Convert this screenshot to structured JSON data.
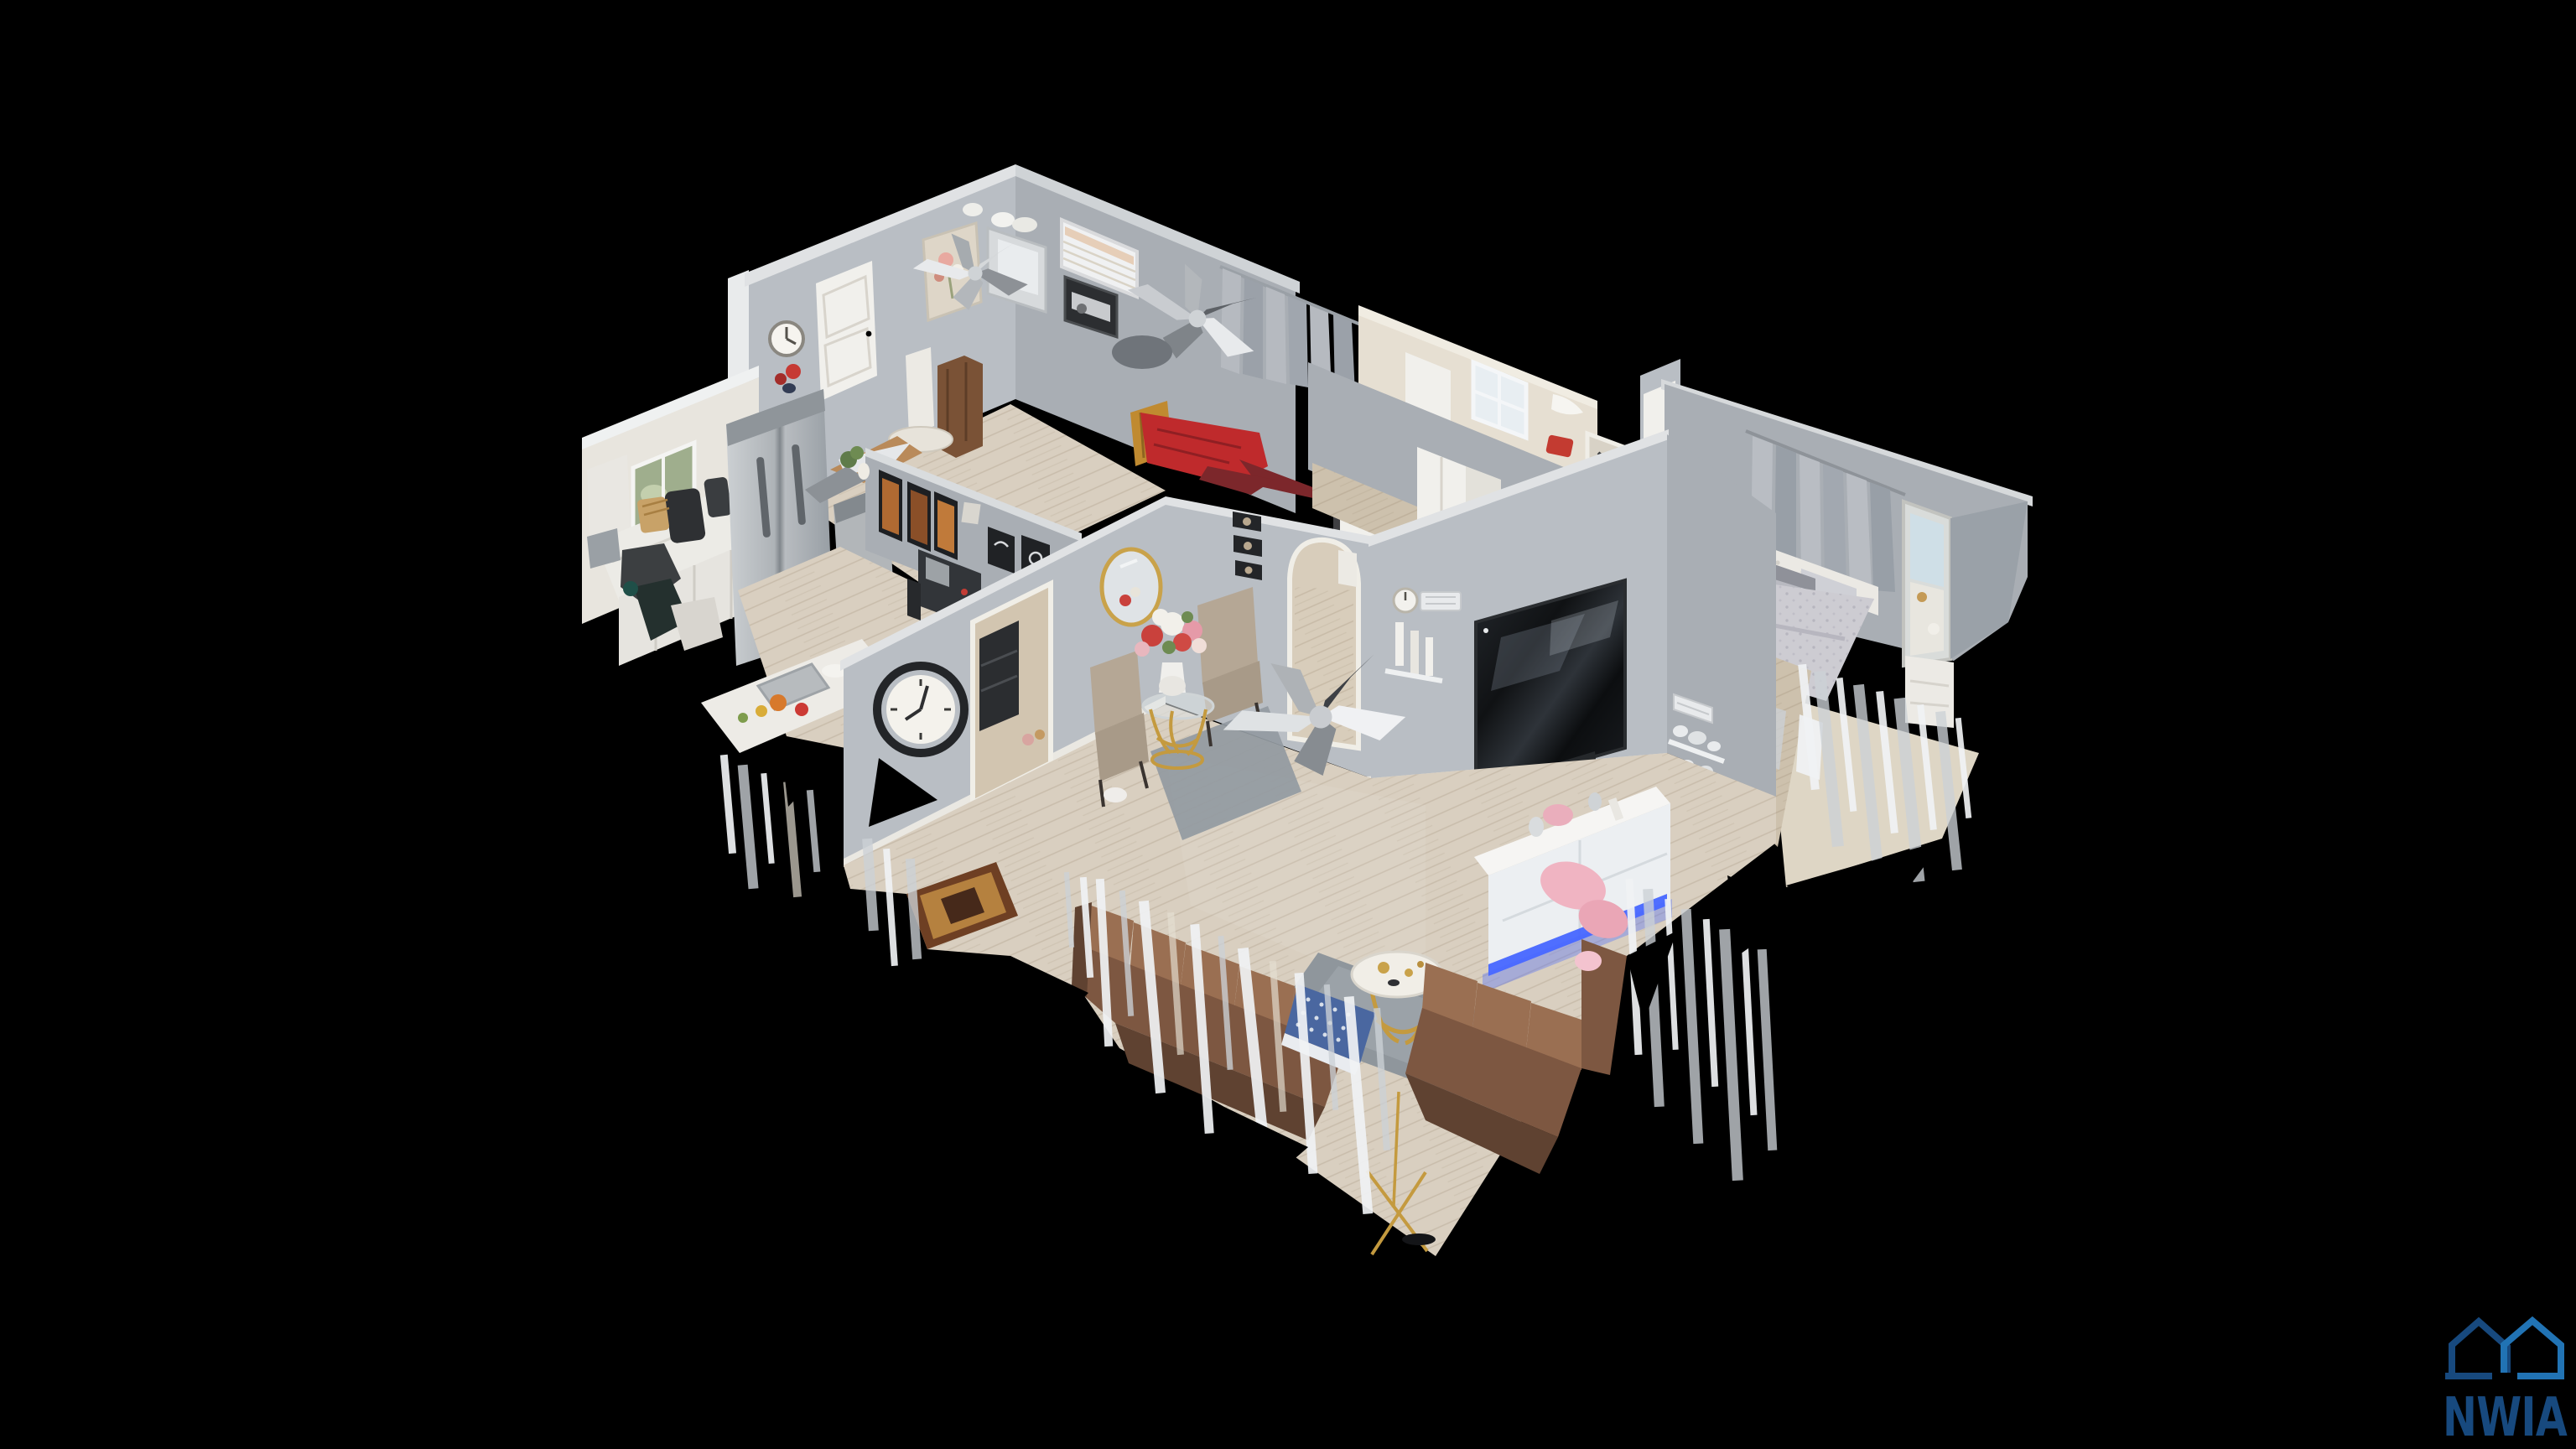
{
  "watermark": {
    "brand": "NWIA",
    "icon": "twin-houses-outline-icon"
  },
  "scene": {
    "type": "3d-dollhouse-scan",
    "rooms": [
      "kitchen",
      "dining-room",
      "bedroom-2",
      "bathroom",
      "hallway",
      "master-bedroom",
      "living-room"
    ]
  },
  "palette": {
    "bg": "#000000",
    "logoNavy": "#17497e",
    "logoBlue": "#2173b4",
    "wallLight": "#b9bec4",
    "wallMid": "#a9aeb4",
    "wallDark": "#989ea5",
    "wallTop": "#e0e2e4",
    "wallWhite": "#e8e5de",
    "creamWall": "#e6dfd2",
    "floorWood": "#d9cfc0",
    "floorWoodDark": "#cdc1ad",
    "cabinetWhite": "#e9e7e2",
    "steel": "#b6babd",
    "couchBrown": "#7d5741",
    "couchBrownDark": "#5f4231",
    "couchBrownLight": "#9a6f52",
    "bedRed": "#bf2a2c",
    "carpetRed": "#7c272b",
    "beddingGray": "#cdccd2",
    "rugGray": "#939aa1",
    "ledBlue": "#4766ff",
    "pink": "#f0b4c2",
    "gold": "#c49a3f"
  }
}
